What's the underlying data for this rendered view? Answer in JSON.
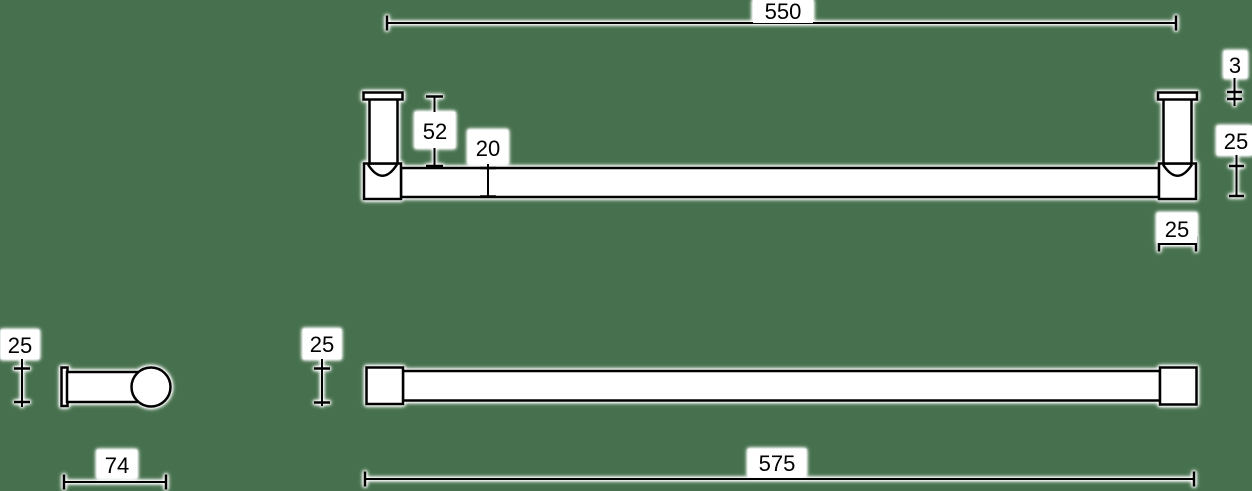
{
  "drawing": "towel rail dimension drawing",
  "colors": {
    "background": "#47714e",
    "line": "#000000",
    "halo": "#ffffff",
    "text": "#000000"
  },
  "views": {
    "front_elevation": {
      "dimensions": {
        "mounting_centres": "550",
        "post_height": "52",
        "rail_diameter": "20",
        "flange_thickness": "3",
        "post_depth": "25",
        "post_width": "25"
      }
    },
    "end_view": {
      "dimensions": {
        "rail_height": "25",
        "projection": "74"
      }
    },
    "plan_view": {
      "dimensions": {
        "end_cap": "25",
        "overall_length": "575"
      }
    }
  }
}
